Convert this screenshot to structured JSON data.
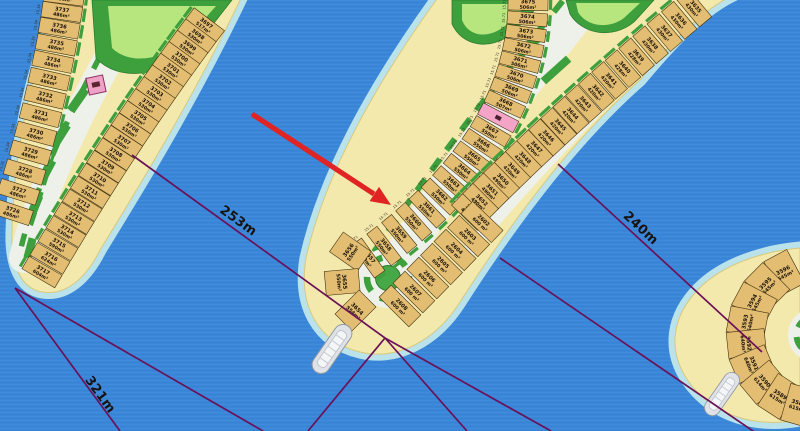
{
  "map": {
    "type": "waterfront-frond-plot-map",
    "water_color": "#3a86d8",
    "sand_color": "#f4e9ad",
    "dimension_line_color": "#6b1158",
    "arrow_color": "#e02424",
    "highlighted_plot_color": "#f4a4c6",
    "dimension_labels": [
      {
        "text": "253m"
      },
      {
        "text": "321m"
      },
      {
        "text": "240m"
      }
    ],
    "edge_dimensions_sample": [
      "15.71",
      "15.34",
      "15.14",
      "15.10",
      "16.10",
      "18.16",
      "20.06",
      "23.41",
      "27.98",
      "28.06",
      "29.91",
      "36.36"
    ],
    "fronds": {
      "left": {
        "west_edge_dim": "15.34",
        "west_plots": [
          {
            "no": "3738",
            "area": "486m²"
          },
          {
            "no": "3737",
            "area": "486m²"
          },
          {
            "no": "3736",
            "area": "486m²"
          },
          {
            "no": "3735",
            "area": "486m²"
          },
          {
            "no": "3734",
            "area": "486m²"
          },
          {
            "no": "3733",
            "area": "486m²"
          },
          {
            "no": "3732",
            "area": "486m²"
          },
          {
            "no": "3731",
            "area": "486m²"
          },
          {
            "no": "3730",
            "area": "486m²"
          },
          {
            "no": "3729",
            "area": "486m²"
          },
          {
            "no": "3728",
            "area": "486m²"
          },
          {
            "no": "3727",
            "area": "486m²"
          },
          {
            "no": "3726",
            "area": "486m²"
          }
        ],
        "east_plots": [
          {
            "no": "3697",
            "area": "517m²"
          },
          {
            "no": "3698",
            "area": "530m²"
          },
          {
            "no": "3699",
            "area": "530m²"
          },
          {
            "no": "3700",
            "area": "530m²"
          },
          {
            "no": "3701",
            "area": "530m²"
          },
          {
            "no": "3702",
            "area": "530m²"
          },
          {
            "no": "3703",
            "area": "530m²"
          },
          {
            "no": "3704",
            "area": "530m²"
          },
          {
            "no": "3705",
            "area": "530m²"
          },
          {
            "no": "3706",
            "area": "530m²"
          },
          {
            "no": "3707",
            "area": "530m²"
          },
          {
            "no": "3708",
            "area": "530m²"
          },
          {
            "no": "3709",
            "area": "530m²"
          },
          {
            "no": "3710",
            "area": "530m²"
          },
          {
            "no": "3711",
            "area": "530m²"
          },
          {
            "no": "3712",
            "area": "530m²"
          },
          {
            "no": "3713",
            "area": "530m²"
          },
          {
            "no": "3714",
            "area": "530m²"
          },
          {
            "no": "3715",
            "area": "590m²"
          },
          {
            "no": "3716",
            "area": "624m²"
          },
          {
            "no": "3717",
            "area": "604m²"
          }
        ]
      },
      "center": {
        "west_edge_dim": "15.71",
        "west_plots": [
          {
            "no": "3675",
            "area": "506m²"
          },
          {
            "no": "3674",
            "area": "506m²"
          },
          {
            "no": "3673",
            "area": "506m²"
          },
          {
            "no": "3672",
            "area": "506m²"
          },
          {
            "no": "3671",
            "area": "506m²"
          },
          {
            "no": "3670",
            "area": "506m²"
          },
          {
            "no": "3669",
            "area": "506m²"
          },
          {
            "no": "3668",
            "area": "507m²"
          },
          {
            "no": "",
            "area": "",
            "highlighted": true
          },
          {
            "no": "3667",
            "area": "550m²"
          },
          {
            "no": "3666",
            "area": "550m²"
          },
          {
            "no": "3665",
            "area": "550m²"
          },
          {
            "no": "3664",
            "area": "550m²"
          },
          {
            "no": "3663",
            "area": "550m²"
          },
          {
            "no": "3662",
            "area": "550m²"
          },
          {
            "no": "3661",
            "area": "550m²"
          },
          {
            "no": "3660",
            "area": "550m²"
          },
          {
            "no": "3659",
            "area": "550m²"
          },
          {
            "no": "3658",
            "area": "550m²"
          },
          {
            "no": "3657",
            "area": "550m²"
          }
        ],
        "tip_plots": [
          {
            "no": "3656",
            "area": "550m²"
          },
          {
            "no": "3655",
            "area": "550m²"
          },
          {
            "no": "3654",
            "area": "554m²"
          }
        ],
        "east_inner_plots": [
          {
            "no": "3635",
            "area": "430m²"
          },
          {
            "no": "3636",
            "area": "430m²"
          },
          {
            "no": "3637",
            "area": "430m²"
          },
          {
            "no": "3638",
            "area": "430m²"
          },
          {
            "no": "3639",
            "area": "428m²"
          },
          {
            "no": "3640",
            "area": "428m²"
          },
          {
            "no": "3641",
            "area": "420m²"
          },
          {
            "no": "3642",
            "area": "420m²"
          },
          {
            "no": "3643",
            "area": "420m²"
          },
          {
            "no": "3644",
            "area": "420m²"
          },
          {
            "no": "3645",
            "area": "420m²"
          },
          {
            "no": "3646",
            "area": "420m²"
          },
          {
            "no": "3647",
            "area": "420m²"
          },
          {
            "no": "3648",
            "area": "420m²"
          },
          {
            "no": "3649",
            "area": "420m²"
          },
          {
            "no": "3650",
            "area": "490m²"
          },
          {
            "no": "3651",
            "area": "490m²"
          },
          {
            "no": "3652",
            "area": "490m²"
          },
          {
            "no": "3653",
            "area": "490m²"
          }
        ],
        "east_outer_plots": [
          {
            "no": "2602",
            "area": "600 m²"
          },
          {
            "no": "2603",
            "area": "600 m²"
          },
          {
            "no": "2604",
            "area": "600 m²"
          },
          {
            "no": "2605",
            "area": "600 m²"
          },
          {
            "no": "2606",
            "area": "600 m²"
          },
          {
            "no": "2607",
            "area": "600 m²"
          },
          {
            "no": "2608",
            "area": "600 m²"
          }
        ]
      },
      "right": {
        "tip_plots": [
          {
            "no": "3596",
            "area": "545m²"
          },
          {
            "no": "3595",
            "area": "545m²"
          },
          {
            "no": "3594",
            "area": "545m²"
          },
          {
            "no": "3593",
            "area": "640m²"
          },
          {
            "no": "3592",
            "area": "640m²"
          },
          {
            "no": "3591",
            "area": "640m²"
          },
          {
            "no": "3590",
            "area": "614m²"
          },
          {
            "no": "3589",
            "area": "615m²"
          },
          {
            "no": "3588",
            "area": "615m²"
          }
        ]
      }
    }
  }
}
